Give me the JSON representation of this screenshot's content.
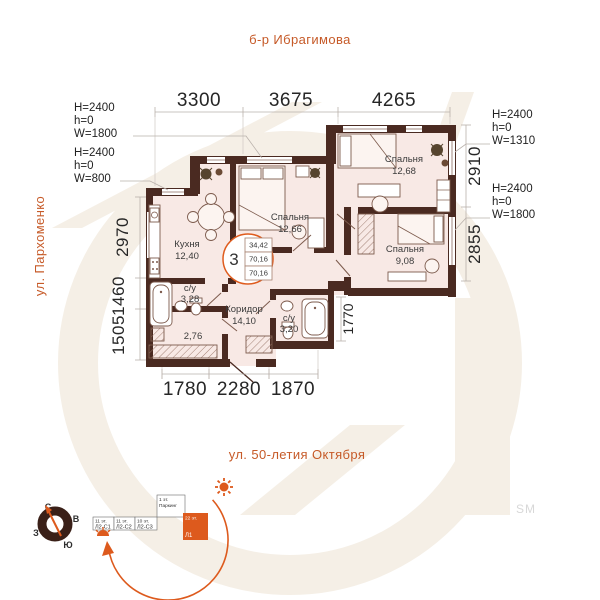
{
  "streets": {
    "top": "б-р Ибрагимова",
    "left": "ул. Пархоменко",
    "bottom": "ул. 50-летия Октября"
  },
  "unit_badge": {
    "number": "3",
    "areas": [
      "34,42",
      "70,16",
      "70,16"
    ]
  },
  "dims": {
    "top": [
      "3300",
      "3675",
      "4265"
    ],
    "bottom": [
      "1780",
      "2280",
      "1870"
    ],
    "left": [
      "2970",
      "1460",
      "1505"
    ],
    "right": [
      "2910",
      "2855"
    ],
    "inner": "1770"
  },
  "window_annotations": [
    {
      "l1": "H=2400",
      "l2": "h=0",
      "l3": "W=1800"
    },
    {
      "l1": "H=2400",
      "l2": "h=0",
      "l3": "W=800"
    },
    {
      "l1": "H=2400",
      "l2": "h=0",
      "l3": "W=1310"
    },
    {
      "l1": "H=2400",
      "l2": "h=0",
      "l3": "W=1800"
    }
  ],
  "rooms": {
    "kitchen": {
      "name": "Кухня",
      "area": "12,40"
    },
    "bedroom1": {
      "name": "Спальня",
      "area": "12,66"
    },
    "bedroom2": {
      "name": "Спальня",
      "area": "12,68"
    },
    "bedroom3": {
      "name": "Спальня",
      "area": "9,08"
    },
    "bath1": {
      "name": "с/у",
      "area": "3,28"
    },
    "storage": {
      "area": "2,76"
    },
    "hall": {
      "name": "Коридор",
      "area": "14,10"
    },
    "bath2": {
      "name": "с/у",
      "area": "3,20"
    }
  },
  "compass": {
    "n": "С",
    "e": "В",
    "s": "Ю",
    "w": "З"
  },
  "scheme": {
    "b1_floors": "11 эт.",
    "b1_name": "Л2-С1",
    "b2_floors": "11 эт.",
    "b2_name": "Л2-С2",
    "b3_floors": "10 эт.",
    "b3_name": "Л2-С3",
    "parking_floors": "1 эт.",
    "parking_name": "Паркинг",
    "tower_floors": "22 эт.",
    "tower_name": "Л1"
  },
  "watermark_label": "SM",
  "colors": {
    "accent": "#dd5a1d",
    "street": "#c65a28",
    "wall": "#4a2a21",
    "floor": "#f8e9e5",
    "watermark": "#f5efe6"
  }
}
